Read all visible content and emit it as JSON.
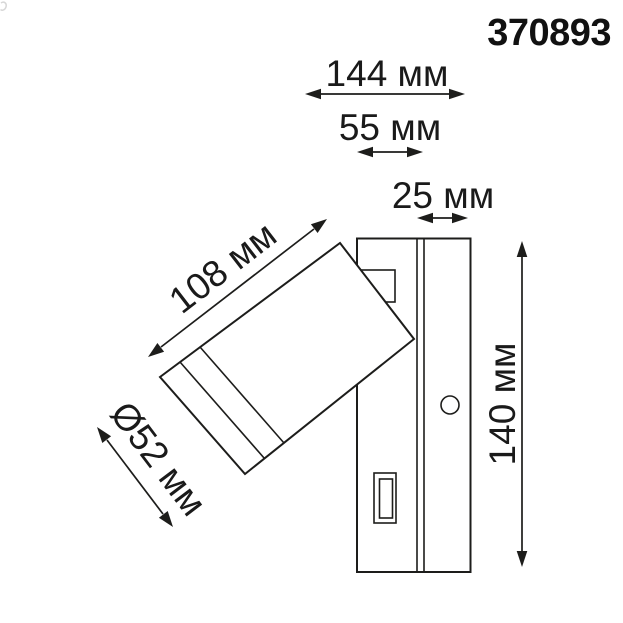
{
  "product_code": "370893",
  "dimensions": {
    "total_width_label": "144 мм",
    "bracket_width_label": "55 мм",
    "base_depth_label": "25 мм",
    "spot_length_label": "108 мм",
    "spot_diameter_label": "Ø52 мм",
    "base_height_label": "140 мм"
  },
  "drawing": {
    "subject": "wall-mounted-rotatable-spot-luminaire-side-view",
    "features": [
      "spot-head",
      "mount-plate",
      "swivel-bracket",
      "round-button",
      "usb-port"
    ]
  },
  "colors": {
    "line": "#1d1d1b",
    "text": "#1a1a1a",
    "background": "#ffffff"
  }
}
